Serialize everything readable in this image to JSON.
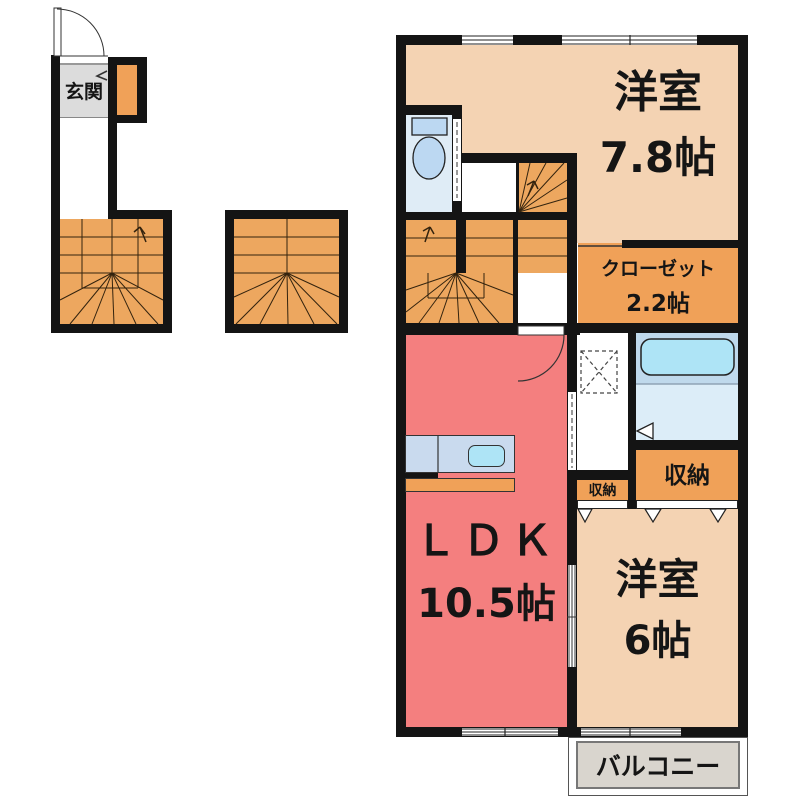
{
  "plan_type": "floor-plan",
  "colors": {
    "wall": "#141414",
    "room_tan": "#F4D3B3",
    "stair_orange": "#EDA75F",
    "storage_orange": "#F0A158",
    "ldk_pink": "#F47F7F",
    "toilet_floor": "#DFECF6",
    "fixture_blue": "#BCD8F2",
    "tub_zone": "#BFD9EC",
    "tub_fill": "#AEE4F6",
    "washroom_blue": "#DCEDF8",
    "balcony_gray": "#D9D5CE",
    "genkan_gray": "#DCDCDC",
    "counter_blue": "#C9DAEE",
    "line_dark": "#333333"
  },
  "rooms": {
    "genkan": {
      "label": "玄関"
    },
    "bedroom1": {
      "label": "洋室",
      "size": "7.8帖"
    },
    "closet": {
      "label": "クローゼット",
      "size": "2.2帖"
    },
    "ldk": {
      "label": "ＬＤＫ",
      "size": "10.5帖"
    },
    "storage_hall": {
      "label": "収納"
    },
    "storage_bedroom": {
      "label": "収納"
    },
    "bedroom2": {
      "label": "洋室",
      "size": "6帖"
    },
    "balcony": {
      "label": "バルコニー"
    }
  },
  "fixtures": [
    "toilet-icon",
    "bathtub-icon",
    "kitchen-sink-icon",
    "washing-machine-pan-icon",
    "entrance-door-arc",
    "ldk-door-arc",
    "stair-direction-arrows",
    "bath-door-triangle",
    "closet-slider-triangles"
  ]
}
